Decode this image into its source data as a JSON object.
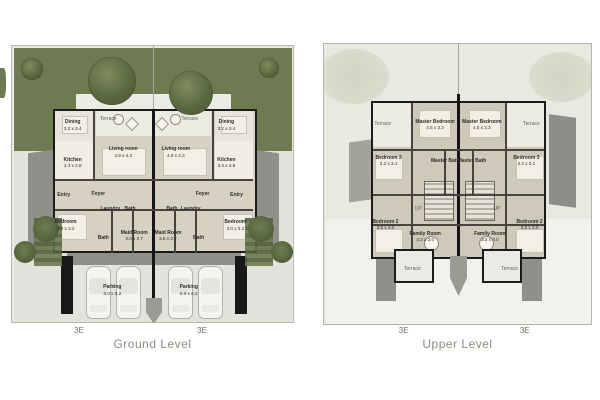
{
  "icons": {
    "tree": "css-gradient-circle",
    "bush": "css-circle",
    "hedge": "css-stripes",
    "car": "css-rounded-rect-top-view",
    "stairs": "css-stripe-hatch"
  },
  "colors": {
    "lawn_green": "#6e7a50",
    "tree_green": "#5a6840",
    "wall_black": "#1b1b1b",
    "ground_floor": "#d6d1c3",
    "upper_floor": "#cfc9bb",
    "paving": "#e3e3dd",
    "gray_wing": "#90908a",
    "caption_text": "#8f8d7e"
  },
  "plans": {
    "ground": {
      "caption": "Ground Level",
      "markers": [
        {
          "label": "3E",
          "x": 24
        },
        {
          "label": "3E",
          "x": 67.5
        }
      ],
      "rooms": [
        {
          "label": "Terrace",
          "dims": "",
          "x": 34.3,
          "y": 26.3,
          "muted": true
        },
        {
          "label": "Terrace",
          "dims": "",
          "x": 63.3,
          "y": 26.3,
          "muted": true
        },
        {
          "label": "Dining",
          "dims": "3.2 x 3.4",
          "x": 21.6,
          "y": 28.8
        },
        {
          "label": "Dining",
          "dims": "3.2 x 3.4",
          "x": 76.3,
          "y": 28.8
        },
        {
          "label": "Living room",
          "dims": "4.9 x 4.3",
          "x": 39.6,
          "y": 38.5
        },
        {
          "label": "Living room",
          "dims": "4.9 x 4.3",
          "x": 58.3,
          "y": 38.5
        },
        {
          "label": "Kitchen",
          "dims": "3.3 x 2.8",
          "x": 21.6,
          "y": 42.4
        },
        {
          "label": "Kitchen",
          "dims": "3.3 x 2.8",
          "x": 76.3,
          "y": 42.4
        },
        {
          "label": "Entry",
          "dims": "",
          "x": 18.4,
          "y": 54
        },
        {
          "label": "Entry",
          "dims": "",
          "x": 79.9,
          "y": 54
        },
        {
          "label": "Foyer",
          "dims": "",
          "x": 30.7,
          "y": 53.5
        },
        {
          "label": "Foyer",
          "dims": "",
          "x": 67.8,
          "y": 53.5
        },
        {
          "label": "Laundry",
          "dims": "",
          "x": 35,
          "y": 59
        },
        {
          "label": "Bath",
          "dims": "",
          "x": 42,
          "y": 59
        },
        {
          "label": "Bath",
          "dims": "",
          "x": 56.9,
          "y": 59
        },
        {
          "label": "Laundry",
          "dims": "",
          "x": 63.6,
          "y": 59
        },
        {
          "label": "Bedroom",
          "dims": "3.0 x 3.2",
          "x": 19.1,
          "y": 65
        },
        {
          "label": "Bedroom",
          "dims": "3.0 x 3.2",
          "x": 79.5,
          "y": 65
        },
        {
          "label": "Bath",
          "dims": "",
          "x": 32.5,
          "y": 69.4
        },
        {
          "label": "Maid Room",
          "dims": "3.5 x 2.7",
          "x": 43.5,
          "y": 68.8
        },
        {
          "label": "Maid Room",
          "dims": "3.5 x 2.7",
          "x": 55.5,
          "y": 68.8
        },
        {
          "label": "Bath",
          "dims": "",
          "x": 66.4,
          "y": 69.4
        },
        {
          "label": "Parking",
          "dims": "6.0 x 6.2",
          "x": 35.7,
          "y": 88.5
        },
        {
          "label": "Parking",
          "dims": "6.0 x 6.2",
          "x": 62.9,
          "y": 88.5
        }
      ]
    },
    "upper": {
      "caption": "Upper Level",
      "markers": [
        {
          "label": "3E",
          "x": 30
        },
        {
          "label": "3E",
          "x": 75
        }
      ],
      "rooms": [
        {
          "label": "Terrace",
          "dims": "",
          "x": 22,
          "y": 28.7,
          "muted": true
        },
        {
          "label": "Master Bedroom",
          "dims": "4.5 x 3.3",
          "x": 41.6,
          "y": 29
        },
        {
          "label": "Master Bedroom",
          "dims": "4.5 x 3.3",
          "x": 59.1,
          "y": 29
        },
        {
          "label": "Terrace",
          "dims": "",
          "x": 77.7,
          "y": 28.7,
          "muted": true
        },
        {
          "label": "Bedroom 3",
          "dims": "3.2 x 3.1",
          "x": 24.2,
          "y": 41.8
        },
        {
          "label": "Master Bath",
          "dims": "",
          "x": 45.4,
          "y": 41.8
        },
        {
          "label": "Master Bath",
          "dims": "",
          "x": 55.4,
          "y": 41.8
        },
        {
          "label": "Bedroom 3",
          "dims": "3.2 x 3.1",
          "x": 75.8,
          "y": 41.8
        },
        {
          "label": "UP",
          "dims": "",
          "x": 35.3,
          "y": 58.9,
          "muted": true
        },
        {
          "label": "UP",
          "dims": "",
          "x": 64.7,
          "y": 58.9,
          "muted": true
        },
        {
          "label": "Bedroom 2",
          "dims": "3.5 x 3.0",
          "x": 23,
          "y": 64.5
        },
        {
          "label": "Family Room",
          "dims": "3.2 x 3.0",
          "x": 37.9,
          "y": 68.8
        },
        {
          "label": "Family Room",
          "dims": "3.2 x 3.0",
          "x": 62.1,
          "y": 68.8
        },
        {
          "label": "Bedroom 2",
          "dims": "3.5 x 3.0",
          "x": 77,
          "y": 64.5
        },
        {
          "label": "Terrace",
          "dims": "",
          "x": 33.1,
          "y": 80.5,
          "muted": true
        },
        {
          "label": "Terrace",
          "dims": "",
          "x": 69.5,
          "y": 80.5,
          "muted": true
        }
      ]
    }
  }
}
